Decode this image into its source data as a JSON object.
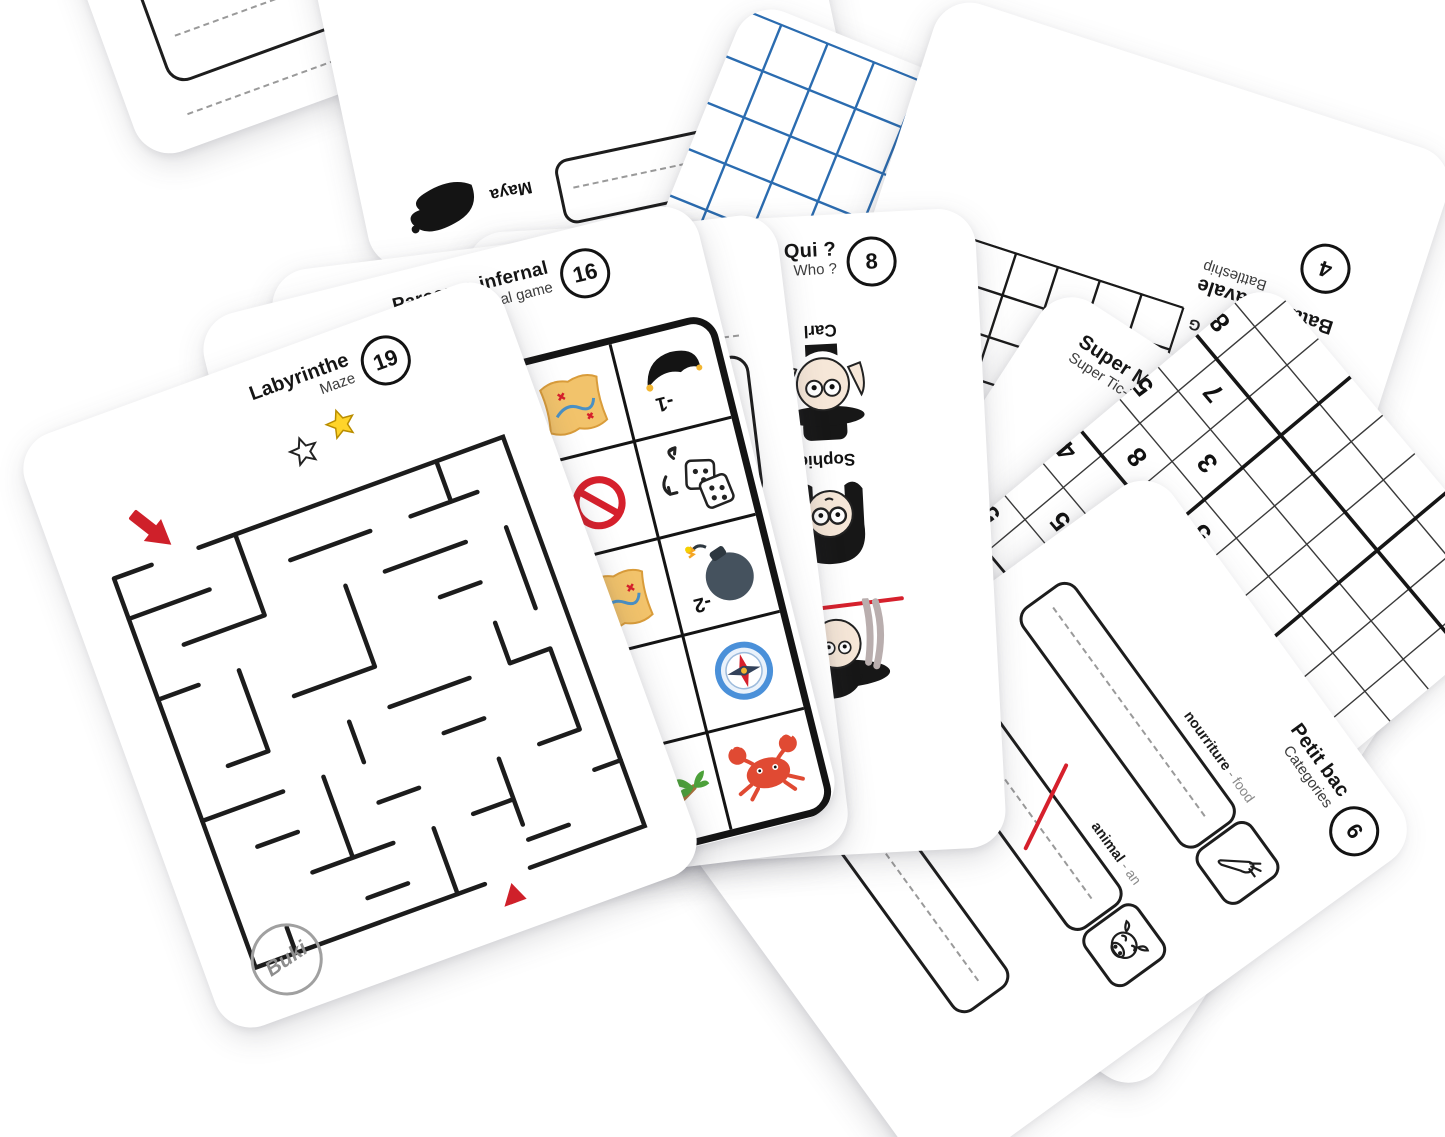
{
  "brand": {
    "name": "Buki"
  },
  "cards": {
    "labyrinthe": {
      "title": "Labyrinthe",
      "subtitle": "Maze",
      "number": "19"
    },
    "parcours": {
      "title": "Parcours infernal",
      "subtitle": "infernal game",
      "number": "16",
      "penalty_hat": "-1",
      "penalty_bomb": "-2"
    },
    "petit_bac_back": {
      "title": "Petit bac",
      "subtitle": "Categories",
      "number": "6",
      "label_partial": "nourriture - f"
    },
    "qui": {
      "title": "Qui ?",
      "subtitle": "Who ?",
      "number": "8",
      "names": [
        "Mar",
        "Carl",
        "Sophie"
      ]
    },
    "maya_card": {
      "name": "Maya"
    },
    "blue_grid": {
      "headers": [
        "6",
        "7"
      ]
    },
    "bataille": {
      "title": "Bataille navale",
      "subtitle": "Battleship",
      "number": "4",
      "letters": [
        "A",
        "B",
        "C",
        "D",
        "E",
        "F",
        "G"
      ],
      "numbers": [
        "1",
        "2",
        "3",
        "4"
      ]
    },
    "morpion": {
      "title": "Super Morpion",
      "subtitle": "Super Tic-Tac-Toe",
      "number": "2"
    },
    "sudoku": {
      "title": "Sudoku",
      "number": "14",
      "digits": [
        "8",
        "7",
        "5",
        "3",
        "8",
        "5",
        "4",
        "6",
        "5",
        "8",
        "5",
        "9"
      ]
    },
    "petit_bac_front": {
      "title": "Petit bac",
      "subtitle": "Categories",
      "number": "6",
      "rows": [
        {
          "fr": "nourriture",
          "en": " - food"
        },
        {
          "fr": "animal",
          "en": " - an"
        }
      ]
    }
  },
  "colors": {
    "accent_red": "#d6202c",
    "grid_blue": "#2b6cb0",
    "star_yellow": "#ffd42a"
  }
}
